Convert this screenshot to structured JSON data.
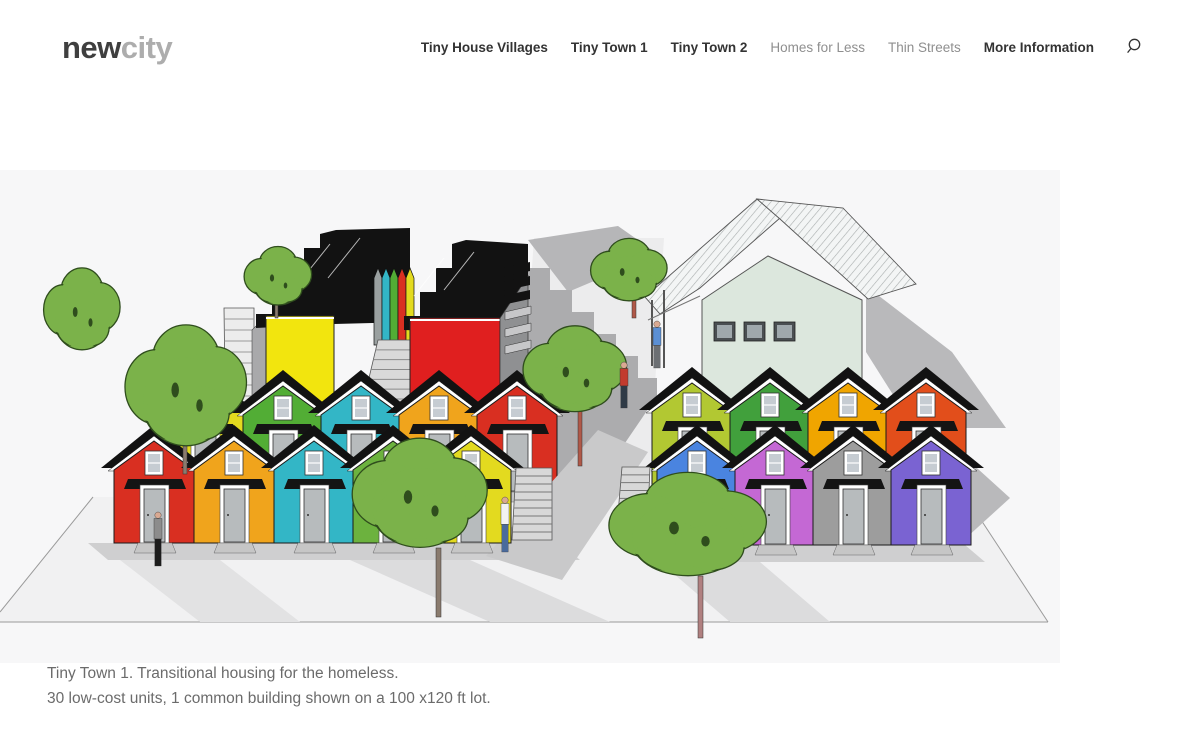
{
  "header": {
    "logo": {
      "part1": "new",
      "part2": "city"
    },
    "nav": [
      {
        "label": "Tiny House Villages",
        "emphasis": "dark"
      },
      {
        "label": "Tiny Town 1",
        "emphasis": "dark"
      },
      {
        "label": "Tiny Town 2",
        "emphasis": "dark"
      },
      {
        "label": "Homes for Less",
        "emphasis": "gray"
      },
      {
        "label": "Thin Streets",
        "emphasis": "gray"
      },
      {
        "label": "More Information",
        "emphasis": "dark"
      }
    ],
    "search_icon": "magnifier"
  },
  "caption": {
    "line1": "Tiny Town 1. Transitional housing for the homeless.",
    "line2": "30 low-cost units, 1 common building shown on a 100 x120 ft lot."
  },
  "illustration": {
    "description": "axonometric rendering of a tiny house village: two rows of colorful gabled cabins on each side of a walkway, two black-roofed rowhouse blocks, one common building, trees and people on a 100x120 ft lot",
    "palette": {
      "background": "#f7f7f8",
      "ground": "#f1f1f2",
      "walkway": "#ececed",
      "roof_black": "#121212",
      "shadow": "#b9b9bb",
      "tree_green": "#7bb24a",
      "common_wall": "#dce7dd"
    },
    "shapes_base": [
      {
        "t": "r",
        "x": 0,
        "y": 170,
        "w": 1060,
        "h": 493,
        "f": "#f7f7f8"
      },
      {
        "t": "p",
        "pts": "93,497 966,497 1048,622 0,622 0,611",
        "f": "#f1f1f2"
      },
      {
        "t": "p",
        "pts": "534,238 664,238 648,500 516,500",
        "f": "#ececed"
      },
      {
        "t": "l",
        "x1": 93,
        "y1": 497,
        "x2": 0,
        "y2": 612,
        "s": "#9a9a9a",
        "w": 1
      },
      {
        "t": "l",
        "x1": 0,
        "y1": 622,
        "x2": 1048,
        "y2": 622,
        "s": "#9a9a9a",
        "w": 1
      },
      {
        "t": "l",
        "x1": 966,
        "y1": 497,
        "x2": 1048,
        "y2": 622,
        "s": "#9a9a9a",
        "w": 1
      }
    ],
    "shapes_back": [
      {
        "t": "p",
        "pts": "528,240 618,226 658,254 568,292",
        "f": "#b6b6b8"
      },
      {
        "t": "p",
        "pts": "510,300 528,268 550,268 550,290 572,290 572,312 594,312 594,334 616,334 616,356 638,356 638,378 657,378 657,396 608,468 540,488 510,432",
        "f": "#acacae"
      },
      {
        "t": "st",
        "tx": 224,
        "tw": 30,
        "ty": 308,
        "bx": 226,
        "bw": 28,
        "by": 462,
        "n": 14,
        "f": "#ececec",
        "sc": "#9a9a9a"
      },
      {
        "t": "p",
        "pts": "252,330 266,316 266,462 252,470",
        "f": "#a9a9ab",
        "s": "#444",
        "w": 0.6
      },
      {
        "t": "p",
        "pts": "256,328 256,314 272,314 272,292 288,292 288,270 304,270 304,248 320,248 320,234 336,230 410,228 410,322 334,324",
        "f": "#121212"
      },
      {
        "t": "l",
        "x1": 300,
        "y1": 252,
        "x2": 268,
        "y2": 292,
        "s": "#ffffff",
        "w": 1,
        "o": 0.7
      },
      {
        "t": "l",
        "x1": 330,
        "y1": 244,
        "x2": 298,
        "y2": 284,
        "s": "#ffffff",
        "w": 1,
        "o": 0.7
      },
      {
        "t": "l",
        "x1": 360,
        "y1": 238,
        "x2": 328,
        "y2": 278,
        "s": "#ffffff",
        "w": 1,
        "o": 0.7
      },
      {
        "t": "r",
        "x": 266,
        "y": 316,
        "w": 68,
        "h": 146,
        "f": "#f2e50e",
        "s": "#222",
        "sw": 1
      },
      {
        "t": "l",
        "x1": 266,
        "y1": 318,
        "x2": 334,
        "y2": 318,
        "s": "#ffffff",
        "w": 2
      },
      {
        "t": "p",
        "pts": "374,345 374,278 378,268 382,278 382,345",
        "f": "#9aa0a0",
        "s": "#111",
        "w": 0.7
      },
      {
        "t": "p",
        "pts": "382,345 382,278 386,268 390,278 390,345",
        "f": "#33b6c6",
        "s": "#111",
        "w": 0.7
      },
      {
        "t": "p",
        "pts": "390,345 390,278 394,268 398,278 398,345",
        "f": "#52ad35",
        "s": "#111",
        "w": 0.7
      },
      {
        "t": "p",
        "pts": "398,345 398,278 402,268 406,278 406,345",
        "f": "#d92f21",
        "s": "#111",
        "w": 0.7
      },
      {
        "t": "p",
        "pts": "406,345 406,278 410,268 414,278 414,345",
        "f": "#e3da1f",
        "s": "#111",
        "w": 0.7
      },
      {
        "t": "st",
        "tx": 378,
        "tw": 40,
        "ty": 340,
        "bx": 350,
        "bw": 96,
        "by": 458,
        "n": 12,
        "f": "#d9d9d9",
        "sc": "#8a8a8a"
      },
      {
        "t": "p",
        "pts": "404,330 404,316 420,316 420,292 436,292 436,268 452,268 452,244 466,240 528,244 528,332 462,332",
        "f": "#121212"
      },
      {
        "t": "l",
        "x1": 444,
        "y1": 258,
        "x2": 414,
        "y2": 296,
        "s": "#ffffff",
        "w": 1,
        "o": 0.7
      },
      {
        "t": "l",
        "x1": 474,
        "y1": 252,
        "x2": 444,
        "y2": 290,
        "s": "#ffffff",
        "w": 1,
        "o": 0.7
      },
      {
        "t": "r",
        "x": 410,
        "y": 318,
        "w": 90,
        "h": 144,
        "f": "#e01f1f",
        "s": "#222",
        "sw": 1
      },
      {
        "t": "l",
        "x1": 410,
        "y1": 320,
        "x2": 500,
        "y2": 320,
        "s": "#ffffff",
        "w": 2
      },
      {
        "t": "p",
        "pts": "500,318 528,276 528,368 500,462",
        "f": "#8f9092",
        "s": "#333",
        "w": 0.7
      },
      {
        "t": "p",
        "pts": "502,268 530,262 530,271 502,277",
        "f": "#121212"
      },
      {
        "t": "p",
        "pts": "502,282 530,276 530,285 502,291",
        "f": "#121212"
      },
      {
        "t": "p",
        "pts": "502,296 530,290 530,299 502,305",
        "f": "#121212"
      },
      {
        "t": "p",
        "pts": "505,312 531,306 531,314 505,320",
        "f": "#c7c7c9",
        "s": "#333",
        "w": 0.5
      },
      {
        "t": "p",
        "pts": "505,329 531,323 531,331 505,337",
        "f": "#c7c7c9",
        "s": "#333",
        "w": 0.5
      },
      {
        "t": "p",
        "pts": "505,346 531,340 531,348 505,354",
        "f": "#c7c7c9",
        "s": "#333",
        "w": 0.5
      },
      {
        "t": "p",
        "pts": "866,286 952,352 1006,428 914,428 866,352",
        "f": "#b9b9bb"
      },
      {
        "t": "p",
        "pts": "702,456 702,300 768,256 862,300 862,456",
        "f": "#dce7dd",
        "s": "#555",
        "w": 1
      },
      {
        "t": "r",
        "x": 714,
        "y": 322,
        "w": 21,
        "h": 19,
        "f": "#4a4f52",
        "s": "#222",
        "sw": 0.8
      },
      {
        "t": "r",
        "x": 717,
        "y": 325,
        "w": 15,
        "h": 13,
        "f": "#9fa8ac"
      },
      {
        "t": "r",
        "x": 744,
        "y": 322,
        "w": 21,
        "h": 19,
        "f": "#4a4f52",
        "s": "#222",
        "sw": 0.8
      },
      {
        "t": "r",
        "x": 747,
        "y": 325,
        "w": 15,
        "h": 13,
        "f": "#9fa8ac"
      },
      {
        "t": "r",
        "x": 774,
        "y": 322,
        "w": 21,
        "h": 19,
        "f": "#4a4f52",
        "s": "#222",
        "sw": 0.8
      },
      {
        "t": "r",
        "x": 777,
        "y": 325,
        "w": 15,
        "h": 13,
        "f": "#9fa8ac"
      },
      {
        "t": "roof",
        "pts": "757,199 645,297 660,314 700,288 780,218"
      },
      {
        "t": "roof",
        "pts": "757,199 843,208 916,284 868,299 780,219"
      },
      {
        "t": "l",
        "x1": 652,
        "y1": 300,
        "x2": 652,
        "y2": 366,
        "s": "#555",
        "w": 2
      },
      {
        "t": "l",
        "x1": 664,
        "y1": 290,
        "x2": 664,
        "y2": 368,
        "s": "#555",
        "w": 2
      },
      {
        "t": "l",
        "x1": 648,
        "y1": 320,
        "x2": 700,
        "y2": 296,
        "s": "#777",
        "w": 1
      }
    ],
    "shapes_mid": [
      {
        "t": "p",
        "pts": "88,543 560,543 580,560 108,560",
        "f": "#cfcfd0"
      },
      {
        "t": "p",
        "pts": "645,545 965,545 985,562 665,562",
        "f": "#cfcfd0"
      },
      {
        "t": "p",
        "pts": "935,430 1010,498 966,538 908,468",
        "f": "#b9b9bb"
      },
      {
        "t": "p",
        "pts": "598,430 648,452 562,580 486,556",
        "f": "#c9c9ca"
      },
      {
        "t": "p",
        "pts": "350,560 470,560 610,622 490,622",
        "f": "#dcdcdd"
      },
      {
        "t": "p",
        "pts": "660,562 760,562 830,622 730,622",
        "f": "#dcdcdd"
      },
      {
        "t": "p",
        "pts": "120,560 220,560 300,622 200,622",
        "f": "#e2e2e3"
      }
    ],
    "shapes_deco": [
      {
        "t": "st",
        "tx": 516,
        "tw": 36,
        "ty": 468,
        "bx": 512,
        "bw": 40,
        "by": 540,
        "n": 9,
        "f": "#d8d8d8",
        "sc": "#777"
      },
      {
        "t": "st",
        "tx": 622,
        "tw": 28,
        "ty": 467,
        "bx": 618,
        "bw": 30,
        "by": 514,
        "n": 6,
        "f": "#d8d8d8",
        "sc": "#777"
      }
    ],
    "house_rows": {
      "order_back": [
        "left_back",
        "right_back"
      ],
      "order_front": [
        "left_front",
        "right_front"
      ],
      "left_back": {
        "apex_y": 382,
        "bottom_y": 492,
        "xs": [
          205,
          283,
          361,
          439,
          517
        ],
        "colors": [
          "#e3da1f",
          "#52ad35",
          "#33b6c6",
          "#f0a41c",
          "#d92f21"
        ]
      },
      "right_back": {
        "apex_y": 379,
        "bottom_y": 490,
        "xs": [
          692,
          770,
          848,
          926
        ],
        "colors": [
          "#b2c832",
          "#41a03c",
          "#f0a500",
          "#e24e1b"
        ]
      },
      "left_front": {
        "apex_y": 437,
        "bottom_y": 543,
        "xs": [
          154,
          234,
          314,
          393,
          471
        ],
        "colors": [
          "#d92f21",
          "#f0a41c",
          "#33b6c6",
          "#6cb23e",
          "#e3da1f"
        ]
      },
      "right_front": {
        "apex_y": 437,
        "bottom_y": 545,
        "xs": [
          697,
          775,
          853,
          931
        ],
        "colors": [
          "#4a84e0",
          "#c468d4",
          "#9d9d9d",
          "#7a63d2"
        ]
      }
    },
    "trees": [
      {
        "cx": 82,
        "cy": 312,
        "rx": 34,
        "ry": 42
      },
      {
        "cx": 278,
        "cy": 278,
        "rx": 30,
        "ry": 30,
        "trunk": [
          275,
          302,
          318,
          3,
          "#8a7b6e"
        ]
      },
      {
        "cx": 629,
        "cy": 272,
        "rx": 34,
        "ry": 32,
        "trunk": [
          632,
          300,
          318,
          4,
          "#b05848"
        ]
      },
      {
        "cx": 575,
        "cy": 372,
        "rx": 46,
        "ry": 44,
        "trunk": [
          578,
          410,
          466,
          4,
          "#b05848"
        ]
      },
      {
        "cx": 186,
        "cy": 390,
        "rx": 54,
        "ry": 62,
        "trunk": [
          183,
          446,
          474,
          4,
          "#8a7b6e"
        ]
      },
      {
        "cx": 420,
        "cy": 497,
        "rx": 60,
        "ry": 56,
        "trunk": [
          436,
          548,
          617,
          5,
          "#8a7b6e"
        ]
      },
      {
        "cx": 688,
        "cy": 528,
        "rx": 70,
        "ry": 53,
        "trunk": [
          698,
          576,
          638,
          5,
          "#b08080"
        ]
      }
    ],
    "people": [
      {
        "x": 158,
        "y": 566,
        "h": 54,
        "t": "#8c8c8c",
        "l": "#1c1c1c"
      },
      {
        "x": 505,
        "y": 552,
        "h": 55,
        "t": "#f2f2f2",
        "l": "#4a6a9c"
      },
      {
        "x": 624,
        "y": 408,
        "h": 46,
        "t": "#c23b2e",
        "l": "#2f3a46"
      },
      {
        "x": 657,
        "y": 368,
        "h": 47,
        "t": "#5b8fd4",
        "l": "#6c6f73"
      }
    ]
  }
}
